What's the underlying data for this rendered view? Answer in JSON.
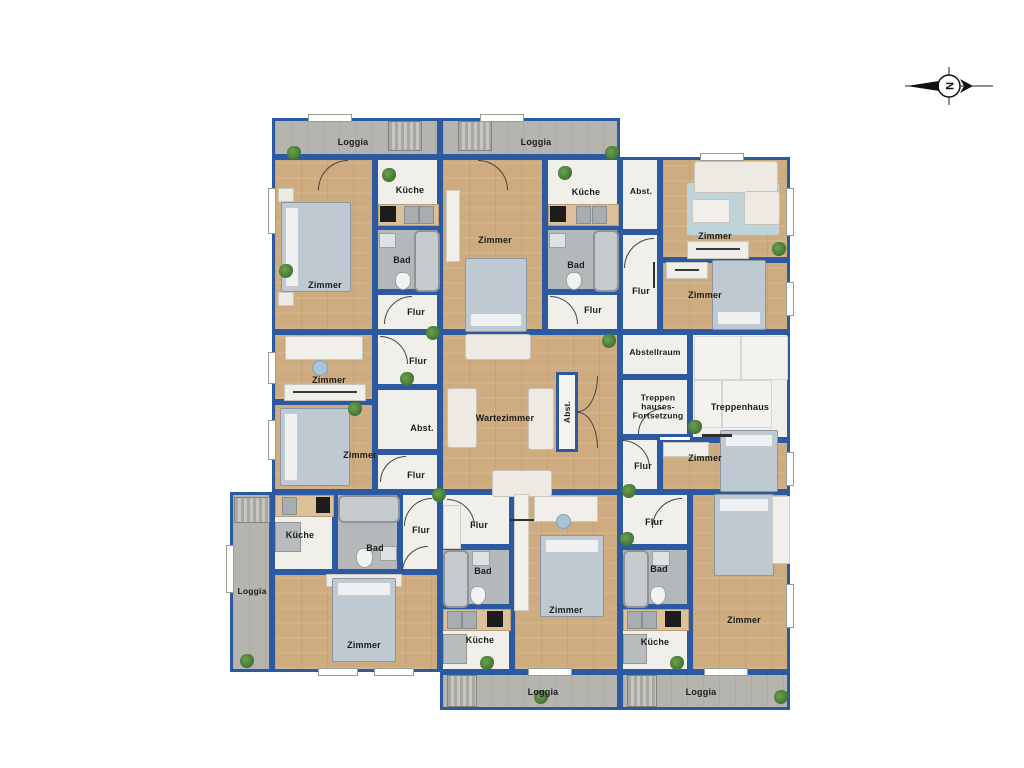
{
  "compass": {
    "letter": "N"
  },
  "rooms": {
    "loggia_top_a": "Loggia",
    "loggia_top_b": "Loggia",
    "zimmer_a": "Zimmer",
    "kueche_a": "Küche",
    "bad_a": "Bad",
    "flur_a": "Flur",
    "zimmer_b": "Zimmer",
    "kueche_b": "Küche",
    "bad_b": "Bad",
    "flur_b": "Flur",
    "abst_c": "Abst.",
    "flur_c": "Flur",
    "zimmer_c1": "Zimmer",
    "zimmer_c2": "Zimmer",
    "zimmer_d1": "Zimmer",
    "zimmer_d2": "Zimmer",
    "flur_d1": "Flur",
    "abst_d": "Abst.",
    "flur_d2": "Flur",
    "wartezimmer": "Wartezimmer",
    "abst_wz": "Abst.",
    "abstellraum": "Abstellraum",
    "treppen_fortsetzung": {
      "l1": "Treppen",
      "l2": "hauses-",
      "l3": "Fortsetzung"
    },
    "treppenhaus": "Treppenhaus",
    "flur_mr": "Flur",
    "zimmer_mr": "Zimmer",
    "loggia_left": "Loggia",
    "kueche_e": "Küche",
    "bad_e": "Bad",
    "flur_e": "Flur",
    "zimmer_e": "Zimmer",
    "flur_f": "Flur",
    "bad_f": "Bad",
    "kueche_f": "Küche",
    "zimmer_f": "Zimmer",
    "loggia_f": "Loggia",
    "flur_g": "Flur",
    "bad_g": "Bad",
    "kueche_g": "Küche",
    "zimmer_g": "Zimmer",
    "loggia_g": "Loggia"
  },
  "colors": {
    "wall": "#2b5aa0",
    "wood_floor": "#cfac80",
    "loggia_floor": "#b6b4af",
    "room_floor": "#f0efe9",
    "bath_floor": "#b4b8ba",
    "plant": "#2f6128",
    "bed": "#bfc9d2",
    "rug": "#bdd8e2"
  }
}
